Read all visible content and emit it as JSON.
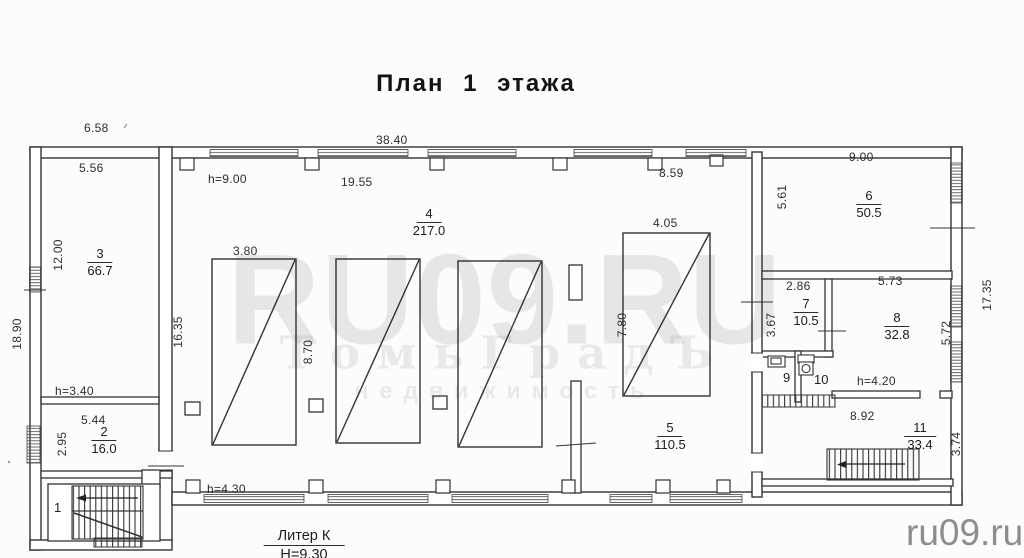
{
  "title": "План 1 этажа",
  "watermark": {
    "main": "RU09.RU",
    "line2": "ТомьГрадЪ",
    "line3": "недвижимость",
    "corner": "ru09.ru"
  },
  "stamp": {
    "liter": "Литер К",
    "height": "Н=9.30"
  },
  "rooms": [
    {
      "num": "1",
      "area": ""
    },
    {
      "num": "2",
      "area": "16.0"
    },
    {
      "num": "3",
      "area": "66.7"
    },
    {
      "num": "4",
      "area": "217.0"
    },
    {
      "num": "5",
      "area": "110.5"
    },
    {
      "num": "6",
      "area": "50.5"
    },
    {
      "num": "7",
      "area": "10.5"
    },
    {
      "num": "8",
      "area": "32.8"
    },
    {
      "num": "9",
      "area": ""
    },
    {
      "num": "10",
      "area": ""
    },
    {
      "num": "11",
      "area": "33.4"
    }
  ],
  "dims": [
    "6.58",
    "38.40",
    "9.00",
    "5.56",
    "h=9.00",
    "19.55",
    "8.59",
    "5.61",
    "12.00",
    "3.80",
    "4.05",
    "17.35",
    "2.86",
    "5.73",
    "18.90",
    "16.35",
    "3.67",
    "8.70",
    "7.80",
    "5.72",
    "h=3.40",
    "h=4.20",
    "5.44",
    "8.92",
    "2.95",
    "3.74",
    "h=4.30"
  ]
}
